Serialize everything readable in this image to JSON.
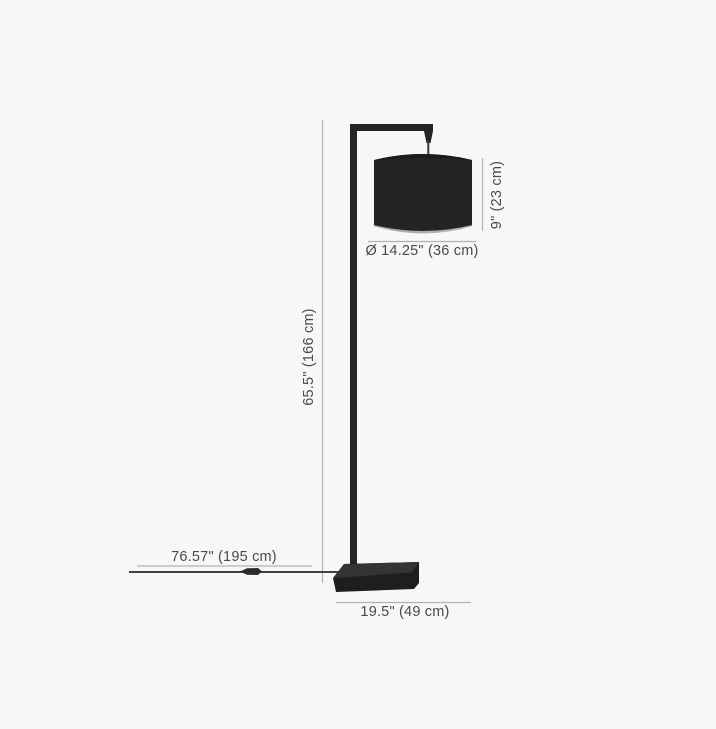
{
  "diagram": {
    "product": "floor-lamp-dimension-diagram",
    "labels": {
      "overall_height": "65.5\" (166 cm)",
      "shade_diameter": "Ø 14.25\" (36 cm)",
      "shade_height": "9\" (23 cm)",
      "cord_length": "76.57\" (195 cm)",
      "base_width": "19.5\" (49 cm)"
    },
    "colors": {
      "background": "#f8f7f5",
      "lamp_body": "#242424",
      "base_front": "#1e1e1e",
      "base_top": "#343434",
      "shade_rim": "#b0aeab",
      "dimension_line": "#b5b2ae",
      "label_text": "#4a4a4a",
      "cord": "#414141"
    }
  }
}
